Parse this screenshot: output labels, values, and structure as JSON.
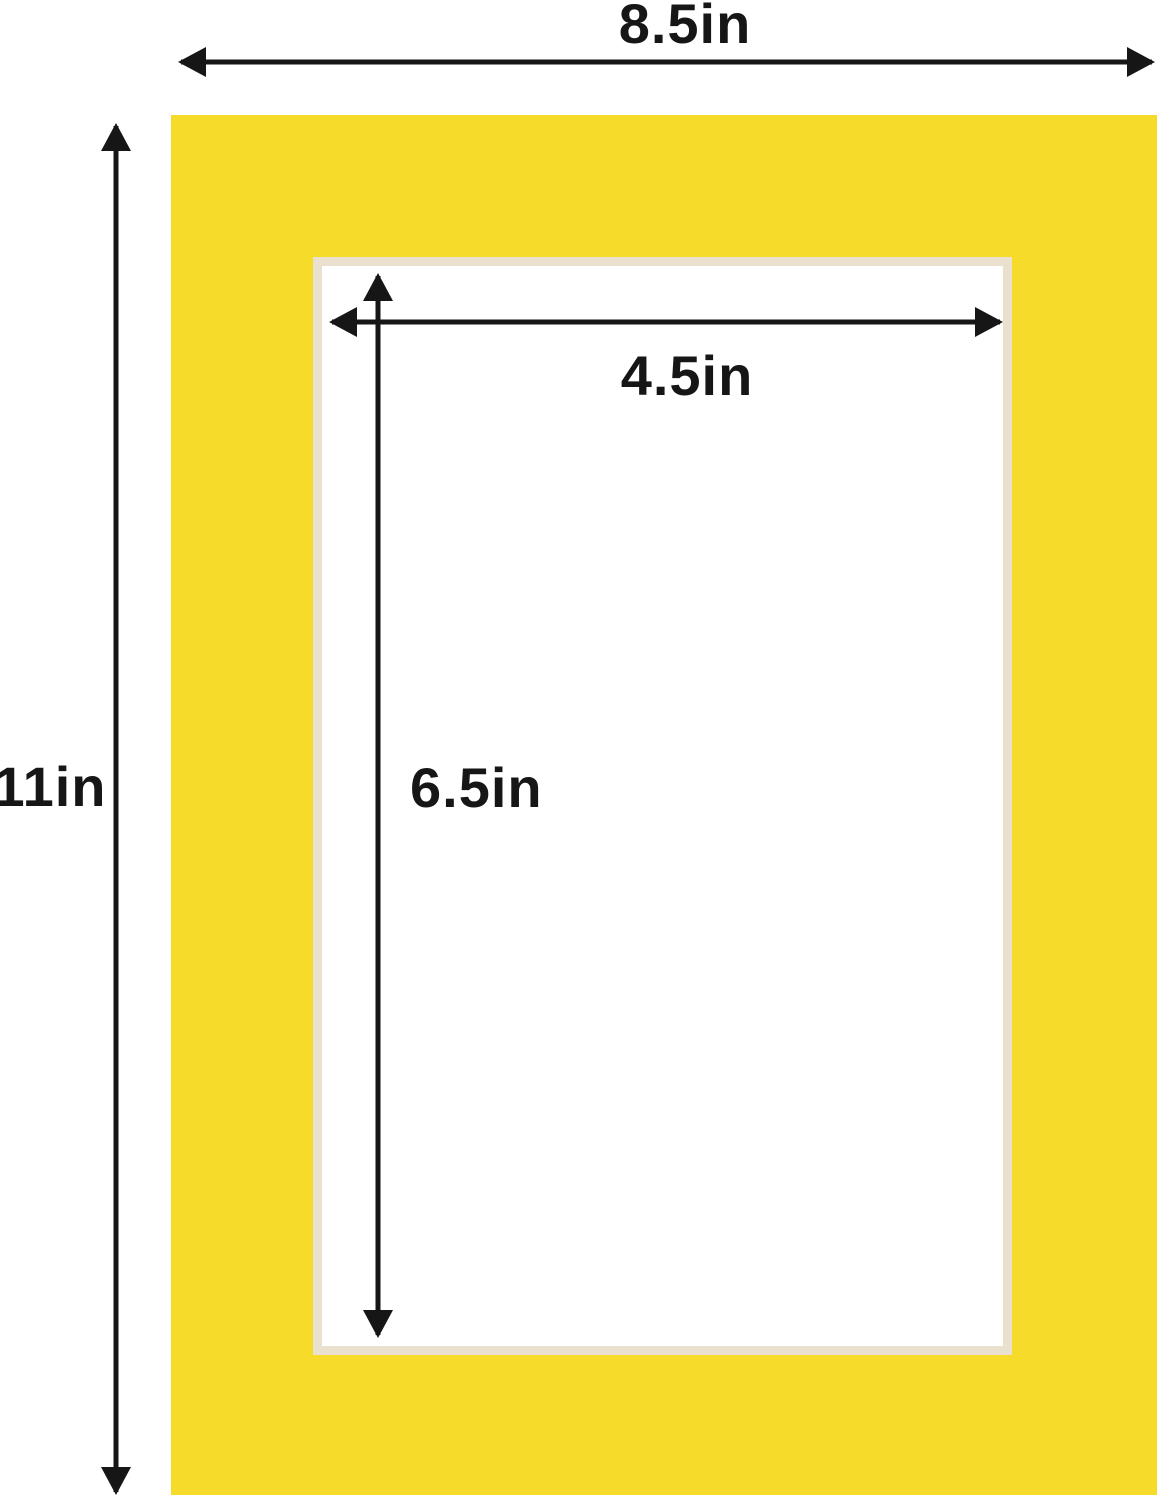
{
  "labels": {
    "overall_width": "8.5in",
    "overall_height": "11in",
    "opening_width": "4.5in",
    "opening_height": "6.5in"
  },
  "colors": {
    "mat_yellow": "#F6DB2B",
    "bevel_cream": "#E9E1CE",
    "arrow_black": "#161616",
    "background": "#FFFFFF"
  }
}
